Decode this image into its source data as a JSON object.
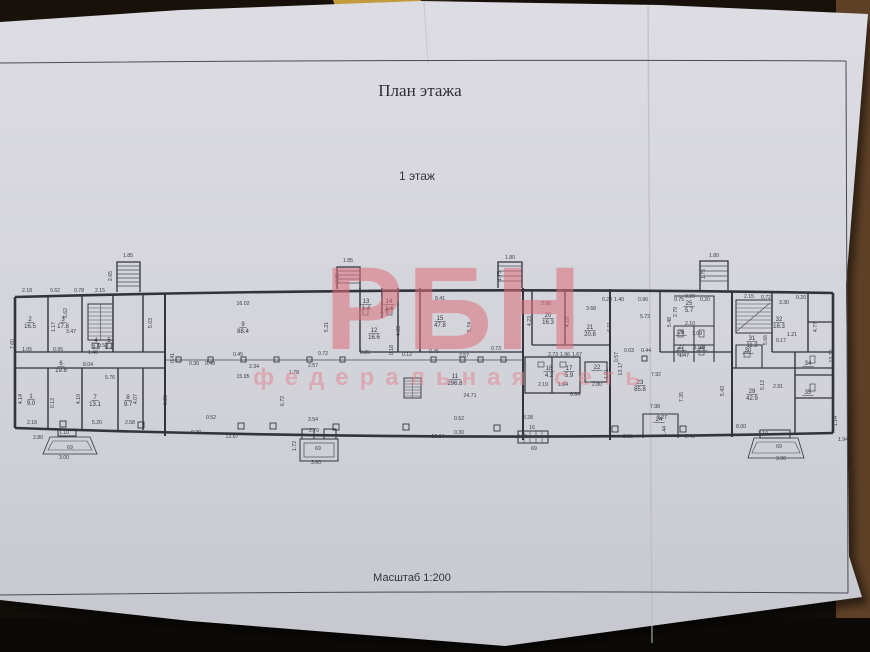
{
  "scene": {
    "background_color": "#261a10",
    "paper_color": "#d6d6dc"
  },
  "document": {
    "title": "План этажа",
    "floor_label": "1 этаж",
    "scale_label": "Масштаб 1:200"
  },
  "watermark": {
    "logo_text": "РБН",
    "subtitle_text": "федеральная сеть",
    "color": "#dd6f7c"
  },
  "plan": {
    "rooms": [
      {
        "n": "1",
        "a": "9.0",
        "x": 31,
        "y": 398
      },
      {
        "n": "2",
        "a": "16.5",
        "x": 30,
        "y": 321
      },
      {
        "n": "3",
        "a": "17.8",
        "x": 63,
        "y": 321
      },
      {
        "n": "4",
        "a": "3.5",
        "x": 96,
        "y": 342
      },
      {
        "n": "5",
        "a": "2.1",
        "x": 109,
        "y": 342
      },
      {
        "n": "6",
        "a": "19.8",
        "x": 61,
        "y": 365
      },
      {
        "n": "7",
        "a": "13.1",
        "x": 95,
        "y": 399
      },
      {
        "n": "8",
        "a": "9.7",
        "x": 128,
        "y": 399
      },
      {
        "n": "9",
        "a": "88.4",
        "x": 243,
        "y": 326
      },
      {
        "n": "11",
        "a": "296.8",
        "x": 455,
        "y": 378
      },
      {
        "n": "12",
        "a": "16.6",
        "x": 374,
        "y": 332
      },
      {
        "n": "13",
        "a": "1.4",
        "x": 366,
        "y": 303
      },
      {
        "n": "14",
        "a": "1.4",
        "x": 389,
        "y": 303
      },
      {
        "n": "15",
        "a": "47.8",
        "x": 440,
        "y": 320
      },
      {
        "n": "17",
        "a": "5.9",
        "x": 569,
        "y": 370
      },
      {
        "n": "18",
        "a": "4.2",
        "x": 549,
        "y": 370
      },
      {
        "n": "20",
        "a": "16.3",
        "x": 548,
        "y": 317
      },
      {
        "n": "21",
        "a": "20.8",
        "x": 590,
        "y": 329
      },
      {
        "n": "22",
        "a": "",
        "x": 597,
        "y": 369
      },
      {
        "n": "23",
        "a": "85.8",
        "x": 640,
        "y": 384
      },
      {
        "n": "24",
        "a": "",
        "x": 659,
        "y": 421
      },
      {
        "n": "25",
        "a": "5.7",
        "x": 689,
        "y": 305
      },
      {
        "n": "26",
        "a": "",
        "x": 681,
        "y": 334
      },
      {
        "n": "27",
        "a": "",
        "x": 681,
        "y": 349
      },
      {
        "n": "28",
        "a": "",
        "x": 702,
        "y": 349
      },
      {
        "n": "29",
        "a": "42.9",
        "x": 752,
        "y": 393
      },
      {
        "n": "30",
        "a": "",
        "x": 748,
        "y": 352
      },
      {
        "n": "31",
        "a": "11.3",
        "x": 752,
        "y": 340
      },
      {
        "n": "32",
        "a": "18.3",
        "x": 779,
        "y": 321
      },
      {
        "n": "34",
        "a": "",
        "x": 808,
        "y": 365
      },
      {
        "n": "35",
        "a": "",
        "x": 808,
        "y": 394
      }
    ],
    "dims": [
      {
        "t": "2.18",
        "x": 27,
        "y": 292
      },
      {
        "t": "0.62",
        "x": 55,
        "y": 292
      },
      {
        "t": "0.78",
        "x": 79,
        "y": 292
      },
      {
        "t": "2.15",
        "x": 100,
        "y": 292
      },
      {
        "t": "1.85",
        "x": 128,
        "y": 257
      },
      {
        "t": "2.65",
        "x": 112,
        "y": 276,
        "r": -90
      },
      {
        "t": "1.85",
        "x": 348,
        "y": 262
      },
      {
        "t": "2.00",
        "x": 339,
        "y": 278,
        "r": -90
      },
      {
        "t": "1.80",
        "x": 510,
        "y": 259
      },
      {
        "t": "1.75",
        "x": 501,
        "y": 276,
        "r": -90
      },
      {
        "t": "1.80",
        "x": 714,
        "y": 257
      },
      {
        "t": "1.75",
        "x": 705,
        "y": 274,
        "r": -90
      },
      {
        "t": "16.02",
        "x": 243,
        "y": 305
      },
      {
        "t": "5.62",
        "x": 67,
        "y": 313,
        "r": -90
      },
      {
        "t": "3.47",
        "x": 71,
        "y": 333
      },
      {
        "t": "1.17",
        "x": 55,
        "y": 327,
        "r": -90
      },
      {
        "t": "5.03",
        "x": 152,
        "y": 323,
        "r": -90
      },
      {
        "t": "0.95",
        "x": 58,
        "y": 351
      },
      {
        "t": "1.40",
        "x": 93,
        "y": 354
      },
      {
        "t": "0.52",
        "x": 103,
        "y": 347
      },
      {
        "t": "1.05",
        "x": 27,
        "y": 351
      },
      {
        "t": "7.60",
        "x": 14,
        "y": 344,
        "r": -90
      },
      {
        "t": "8.04",
        "x": 88,
        "y": 366
      },
      {
        "t": "5.76",
        "x": 110,
        "y": 379
      },
      {
        "t": "4.14",
        "x": 22,
        "y": 399,
        "r": -90
      },
      {
        "t": "0.13",
        "x": 54,
        "y": 403,
        "r": -90
      },
      {
        "t": "4.19",
        "x": 80,
        "y": 399,
        "r": -90
      },
      {
        "t": "4.07",
        "x": 137,
        "y": 399,
        "r": -90
      },
      {
        "t": "2.18",
        "x": 32,
        "y": 424
      },
      {
        "t": "5.20",
        "x": 97,
        "y": 424
      },
      {
        "t": "2.58",
        "x": 130,
        "y": 424
      },
      {
        "t": "2.80",
        "x": 38,
        "y": 439
      },
      {
        "t": "1.10",
        "x": 64,
        "y": 434
      },
      {
        "t": "3.00",
        "x": 64,
        "y": 459
      },
      {
        "t": "69",
        "x": 70,
        "y": 449
      },
      {
        "t": "5.21",
        "x": 328,
        "y": 327,
        "r": -90
      },
      {
        "t": "0.41",
        "x": 174,
        "y": 358,
        "r": -90
      },
      {
        "t": "0.30",
        "x": 194,
        "y": 365
      },
      {
        "t": "0.49",
        "x": 210,
        "y": 365
      },
      {
        "t": "0.45",
        "x": 238,
        "y": 356
      },
      {
        "t": "0.72",
        "x": 323,
        "y": 355
      },
      {
        "t": "2.34",
        "x": 254,
        "y": 368
      },
      {
        "t": "2.57",
        "x": 313,
        "y": 367
      },
      {
        "t": "15.95",
        "x": 243,
        "y": 378
      },
      {
        "t": "6.90",
        "x": 167,
        "y": 400,
        "r": -90
      },
      {
        "t": "6.72",
        "x": 284,
        "y": 401,
        "r": -90
      },
      {
        "t": "1.78",
        "x": 294,
        "y": 374
      },
      {
        "t": "0.52",
        "x": 211,
        "y": 419
      },
      {
        "t": "13.67",
        "x": 232,
        "y": 438
      },
      {
        "t": "0.20",
        "x": 196,
        "y": 434
      },
      {
        "t": "3.54",
        "x": 313,
        "y": 421
      },
      {
        "t": "2.70",
        "x": 314,
        "y": 432
      },
      {
        "t": "69",
        "x": 318,
        "y": 450
      },
      {
        "t": "1.72",
        "x": 296,
        "y": 446,
        "r": -90
      },
      {
        "t": "3.60",
        "x": 316,
        "y": 464
      },
      {
        "t": "2.77",
        "x": 385,
        "y": 313
      },
      {
        "t": "4.03",
        "x": 400,
        "y": 331,
        "r": -90
      },
      {
        "t": "0.85",
        "x": 365,
        "y": 354
      },
      {
        "t": "0.18",
        "x": 393,
        "y": 350,
        "r": -90
      },
      {
        "t": "0.12",
        "x": 407,
        "y": 356
      },
      {
        "t": "8.41",
        "x": 440,
        "y": 300
      },
      {
        "t": "5.74",
        "x": 471,
        "y": 327,
        "r": -90
      },
      {
        "t": "4.23",
        "x": 531,
        "y": 321,
        "r": -90
      },
      {
        "t": "0.45",
        "x": 434,
        "y": 353
      },
      {
        "t": "0.73",
        "x": 496,
        "y": 350
      },
      {
        "t": "2.57",
        "x": 464,
        "y": 357
      },
      {
        "t": "24.71",
        "x": 470,
        "y": 397
      },
      {
        "t": "18.84",
        "x": 438,
        "y": 438
      },
      {
        "t": "0.52",
        "x": 459,
        "y": 420
      },
      {
        "t": "0.30",
        "x": 459,
        "y": 434
      },
      {
        "t": "3.28",
        "x": 528,
        "y": 419
      },
      {
        "t": "2.72",
        "x": 522,
        "y": 438
      },
      {
        "t": "69",
        "x": 534,
        "y": 450
      },
      {
        "t": "16",
        "x": 532,
        "y": 429
      },
      {
        "t": "3.90",
        "x": 546,
        "y": 305
      },
      {
        "t": "3.68",
        "x": 591,
        "y": 310
      },
      {
        "t": "0.20",
        "x": 607,
        "y": 301
      },
      {
        "t": "1.40",
        "x": 619,
        "y": 301
      },
      {
        "t": "0.96",
        "x": 643,
        "y": 301
      },
      {
        "t": "0.75",
        "x": 679,
        "y": 301
      },
      {
        "t": "0.20",
        "x": 705,
        "y": 301
      },
      {
        "t": "5.73",
        "x": 645,
        "y": 318
      },
      {
        "t": "4.19",
        "x": 569,
        "y": 322,
        "r": -90
      },
      {
        "t": "6.11",
        "x": 611,
        "y": 327,
        "r": -90
      },
      {
        "t": "2.73",
        "x": 553,
        "y": 356
      },
      {
        "t": "1.96",
        "x": 565,
        "y": 356
      },
      {
        "t": "1.67",
        "x": 577,
        "y": 356
      },
      {
        "t": "2.19",
        "x": 543,
        "y": 386
      },
      {
        "t": "1.84",
        "x": 563,
        "y": 386
      },
      {
        "t": "6.64",
        "x": 575,
        "y": 396
      },
      {
        "t": "2.80",
        "x": 597,
        "y": 386
      },
      {
        "t": "1.91",
        "x": 608,
        "y": 374,
        "r": -90
      },
      {
        "t": "13.17",
        "x": 622,
        "y": 369,
        "r": -90
      },
      {
        "t": "0.57",
        "x": 618,
        "y": 357,
        "r": -90
      },
      {
        "t": "0.03",
        "x": 629,
        "y": 352
      },
      {
        "t": "0.44",
        "x": 646,
        "y": 352
      },
      {
        "t": "7.92",
        "x": 656,
        "y": 376
      },
      {
        "t": "7.98",
        "x": 655,
        "y": 408
      },
      {
        "t": "7.35",
        "x": 683,
        "y": 397,
        "r": -90
      },
      {
        "t": "5.43",
        "x": 724,
        "y": 391,
        "r": -90
      },
      {
        "t": "3.27",
        "x": 662,
        "y": 419
      },
      {
        "t": "1.44",
        "x": 666,
        "y": 431,
        "r": -90
      },
      {
        "t": "2.40",
        "x": 690,
        "y": 438
      },
      {
        "t": "2.53",
        "x": 628,
        "y": 438
      },
      {
        "t": "2.79",
        "x": 677,
        "y": 312,
        "r": -90
      },
      {
        "t": "2.10",
        "x": 690,
        "y": 325
      },
      {
        "t": "1.09",
        "x": 697,
        "y": 335
      },
      {
        "t": "1.07",
        "x": 699,
        "y": 349
      },
      {
        "t": "1.47",
        "x": 684,
        "y": 357
      },
      {
        "t": "5.48",
        "x": 671,
        "y": 322,
        "r": -90
      },
      {
        "t": "0.20",
        "x": 690,
        "y": 298
      },
      {
        "t": "2.15",
        "x": 749,
        "y": 298
      },
      {
        "t": "0.72",
        "x": 766,
        "y": 299
      },
      {
        "t": "3.30",
        "x": 784,
        "y": 304
      },
      {
        "t": "0.20",
        "x": 801,
        "y": 299
      },
      {
        "t": "5.66",
        "x": 767,
        "y": 340,
        "r": -90
      },
      {
        "t": "0.17",
        "x": 781,
        "y": 342
      },
      {
        "t": "1.21",
        "x": 792,
        "y": 336
      },
      {
        "t": "4.77",
        "x": 817,
        "y": 327,
        "r": -90
      },
      {
        "t": "12.70",
        "x": 833,
        "y": 356,
        "r": -90
      },
      {
        "t": "2.91",
        "x": 778,
        "y": 388
      },
      {
        "t": "0.12",
        "x": 764,
        "y": 385,
        "r": -90
      },
      {
        "t": "8.00",
        "x": 741,
        "y": 428
      },
      {
        "t": "1.94",
        "x": 843,
        "y": 441
      },
      {
        "t": "1.14",
        "x": 837,
        "y": 421,
        "r": -90
      },
      {
        "t": "3.00",
        "x": 781,
        "y": 460
      },
      {
        "t": "69",
        "x": 779,
        "y": 448
      },
      {
        "t": "1.10",
        "x": 763,
        "y": 435
      }
    ]
  }
}
